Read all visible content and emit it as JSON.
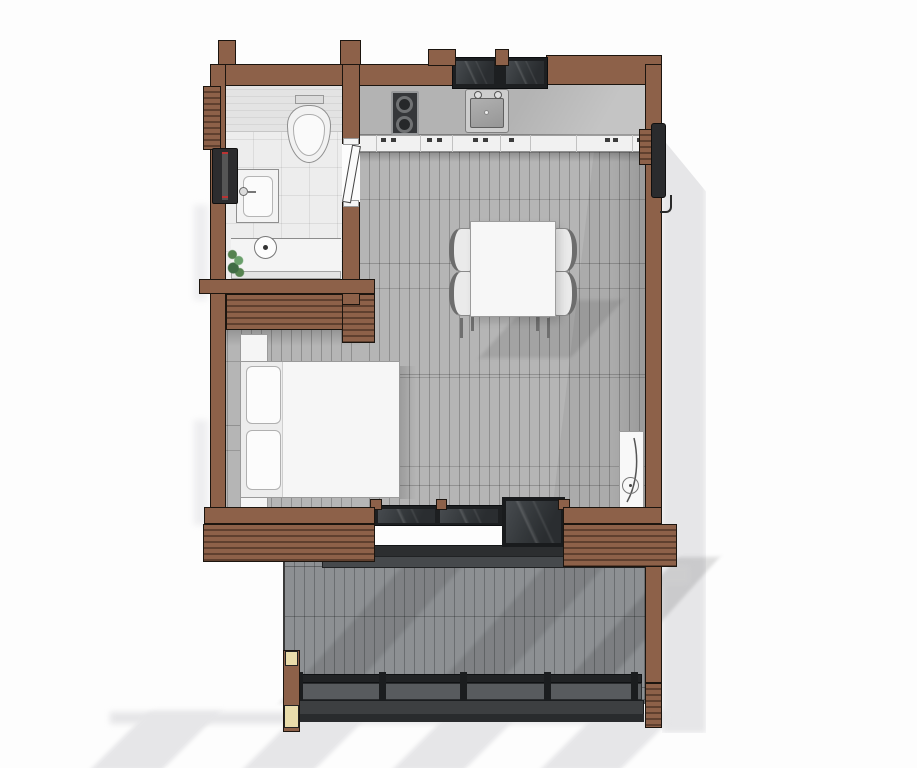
{
  "meta": {
    "type": "architectural-floor-plan",
    "view": "top-down-3d-render",
    "width_px": 917,
    "height_px": 768
  },
  "colors": {
    "background": "#fdfdfd",
    "wall": "#8d6149",
    "wall_dark": "#5f402f",
    "outline": "#1c150f",
    "floor": "#b5b5b5",
    "floor_joint": "#8f8f8f",
    "deck": "#8d9093",
    "deck_joint": "#6b6e71",
    "tile": "#ededed",
    "glass_dark": "#1d1f21",
    "counter": "#b3b3b3",
    "cabinet": "#f1f1f1",
    "furniture": "#f5f5f5",
    "furniture_outline": "#9a9a9a",
    "railing_dark": "#212325",
    "railing_mid": "#585b5e",
    "cream": "#e9dcab",
    "plant_green": "#55824f",
    "shadow": "#e6e6e8"
  },
  "structure": {
    "walls": "interlocked-log-walls-with-projecting-ends",
    "rooms": [
      {
        "name": "bathroom",
        "fixtures": [
          "wall-hung-toilet",
          "flush-plate",
          "washbasin-with-faucet",
          "shower-tray",
          "floor-drain",
          "potted-plant",
          "hinged-door"
        ]
      },
      {
        "name": "kitchen",
        "fixtures": [
          "countertop",
          "two-burner-cooktop",
          "single-basin-sink-with-taps",
          "base-cabinet-fronts",
          "double-pane-window"
        ]
      },
      {
        "name": "living-dining",
        "fixtures": [
          "dining-table",
          "dining-chair",
          "dining-chair",
          "dining-chair",
          "dining-chair",
          "tall-wall-heater"
        ]
      },
      {
        "name": "sleeping-nook",
        "fixtures": [
          "double-bed",
          "pillow",
          "pillow",
          "nightstand",
          "nightstand",
          "log-slat-closet"
        ]
      },
      {
        "name": "deck",
        "fixtures": [
          "sliding-glass-door",
          "open-glass-door-panel",
          "threshold-step",
          "guard-railing",
          "corner-posts",
          "log-stair-strip"
        ]
      }
    ],
    "exterior": [
      "cast-shadows",
      "log-end-projections",
      "dark-window-unit-left-wall",
      "dark-shutter-right-wall"
    ]
  }
}
